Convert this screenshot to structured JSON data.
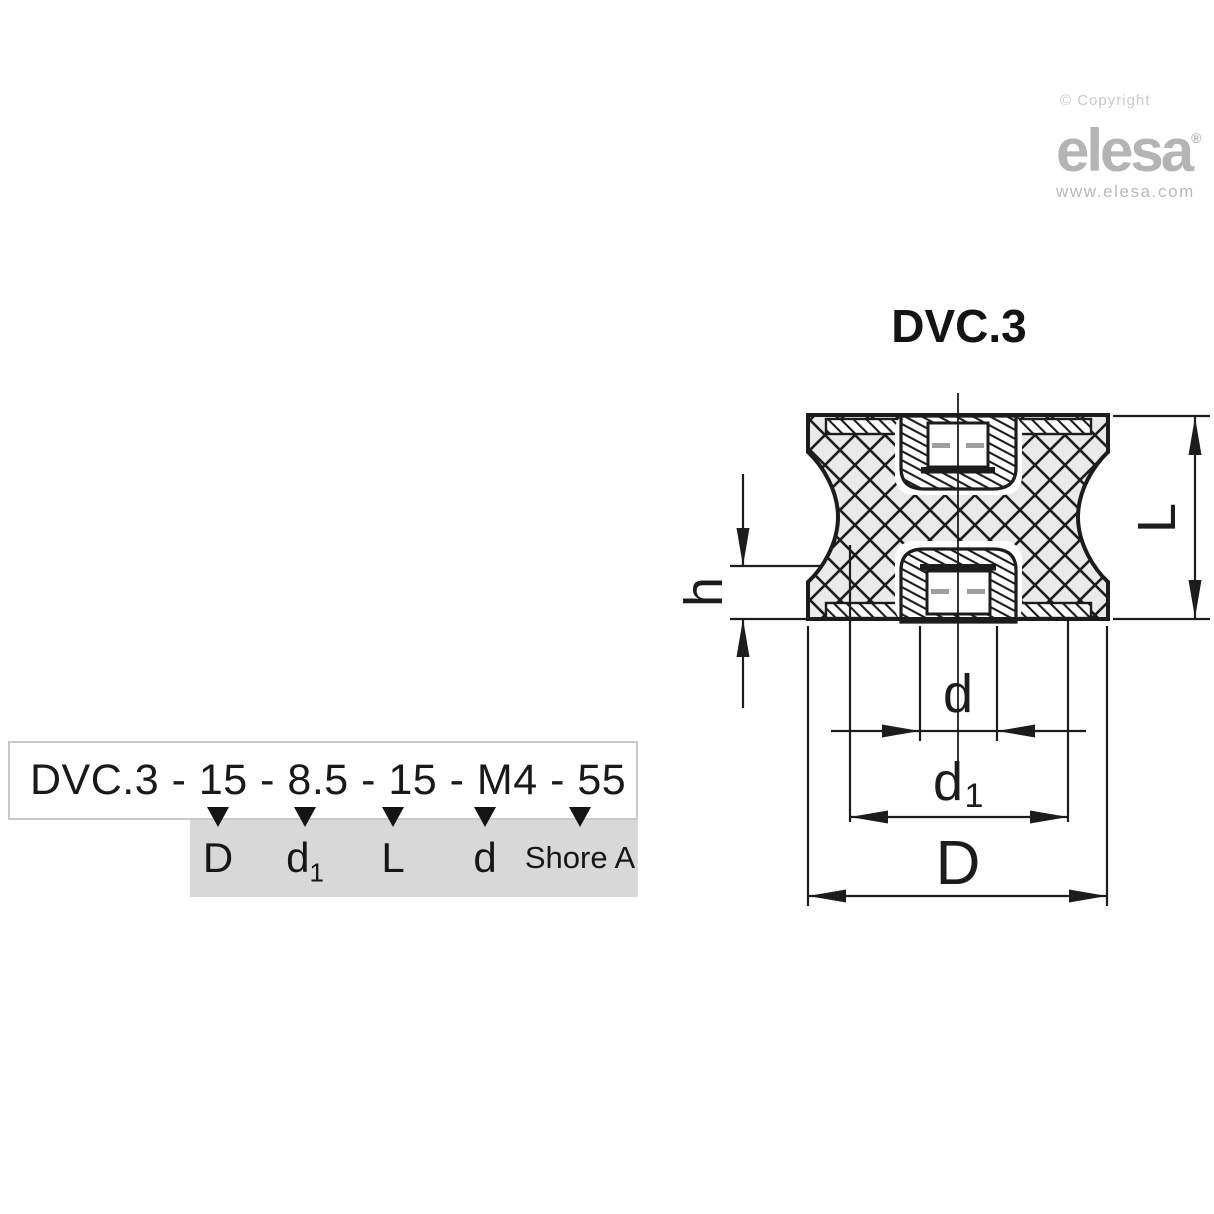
{
  "branding": {
    "copyright": "© Copyright",
    "logo": "elesa",
    "registered": "®",
    "website": "www.elesa.com"
  },
  "title": "DVC.3",
  "drawing": {
    "dim_length": "L",
    "dim_flange_height": "h",
    "dim_thread": "d",
    "dim_insert_main": "d",
    "dim_insert_sub": "1",
    "dim_outer": "D"
  },
  "order_code": {
    "code": "DVC.3 - 15 - 8.5 - 15 - M4 - 55",
    "mappings": [
      {
        "main": "D",
        "sub": ""
      },
      {
        "main": "d",
        "sub": "1"
      },
      {
        "main": "L",
        "sub": ""
      },
      {
        "main": "d",
        "sub": ""
      },
      {
        "main": "Shore A",
        "sub": ""
      }
    ]
  },
  "colors": {
    "line": "#1c1c1c",
    "rubber_fill": "#eaeaea",
    "label_box_bg": "#d8d8d8",
    "code_box_border": "#c9c9c9",
    "logo_gray": "#b4b4b4",
    "copyright_gray": "#c9c9c9"
  }
}
